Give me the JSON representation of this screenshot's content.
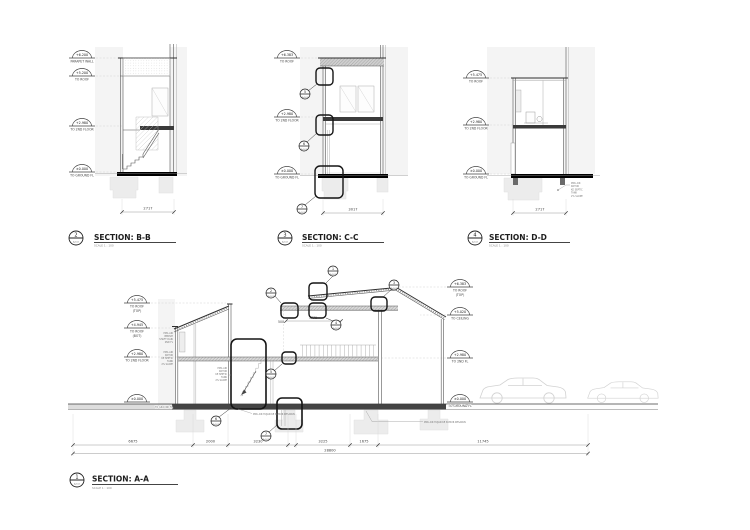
{
  "t": {
    "bb": {
      "num": "2",
      "ref": "A-102",
      "title": "SECTION: B-B",
      "scale": "SCALE  1 : 100"
    },
    "cc": {
      "num": "3",
      "ref": "A-102",
      "title": "SECTION: C-C",
      "scale": "SCALE  1 : 100"
    },
    "dd": {
      "num": "4",
      "ref": "A-102",
      "title": "SECTION: D-D",
      "scale": "SCALE  1 : 100"
    },
    "aa": {
      "num": "1",
      "ref": "A-102",
      "title": "SECTION: A-A",
      "scale": "SCALE  1 : 100"
    }
  },
  "bb": {
    "markers": [
      {
        "v": "+6.200",
        "l1": "PARAPET WALL",
        "l2": ""
      },
      {
        "v": "+5.200",
        "l1": "TO ROOF",
        "l2": ""
      },
      {
        "v": "+2.980",
        "l1": "TO 2ND FLOOR",
        "l2": ""
      },
      {
        "v": "±0.000",
        "l1": "TO GROUND FL",
        "l2": ""
      }
    ],
    "dim": "2717"
  },
  "cc": {
    "markers": [
      {
        "v": "+6.383",
        "l1": "TO ROOF",
        "l2": ""
      },
      {
        "v": "+2.980",
        "l1": "TO 2ND FLOOR",
        "l2": ""
      },
      {
        "v": "±0.000",
        "l1": "TO GROUND FL",
        "l2": ""
      }
    ],
    "dim": "3017",
    "callouts": [
      {
        "n": "5",
        "r": "A-501"
      },
      {
        "n": "6",
        "r": "A-501"
      },
      {
        "n": "7",
        "r": "A-501"
      }
    ]
  },
  "dd": {
    "markers": [
      {
        "v": "+5.475",
        "l1": "TO ROOF",
        "l2": ""
      },
      {
        "v": "+2.980",
        "l1": "TO 2ND FLOOR",
        "l2": ""
      },
      {
        "v": "±0.000",
        "l1": "TO GROUND FL",
        "l2": ""
      }
    ],
    "dim": "2717",
    "note": [
      "PIPA AIR",
      "KOTOR",
      "KE SEPTIC",
      "TANK",
      "2% SLOPE"
    ]
  },
  "aa": {
    "lm": [
      {
        "v": "+5.475",
        "l1": "TO ROOF",
        "l2": "(TOP)"
      },
      {
        "v": "+4.945",
        "l1": "TO ROOF",
        "l2": "(BOT)"
      },
      {
        "v": "+2.980",
        "l1": "TO 2ND FLOOR",
        "l2": ""
      },
      {
        "v": "±0.000",
        "l1": "",
        "l2": ""
      }
    ],
    "rm": [
      {
        "v": "+6.383",
        "l1": "TO ROOF",
        "l2": "(TOP)"
      },
      {
        "v": "+5.020",
        "l1": "TO CEILING",
        "l2": ""
      },
      {
        "v": "+2.980",
        "l1": "TO 2ND FL",
        "l2": ""
      },
      {
        "v": "±0.000",
        "l1": "TO GROUND FL",
        "l2": ""
      }
    ],
    "gl": "TO GROUND FL",
    "dims": [
      "6675",
      "2000",
      "3230",
      "3225",
      "1675",
      "11745"
    ],
    "total": "28800",
    "inner": {
      "d1": "500",
      "d2": "1770"
    },
    "callouts": [
      {
        "n": "1",
        "r": "A-501"
      },
      {
        "n": "2",
        "r": "A-501"
      },
      {
        "n": "3",
        "r": "A-501"
      },
      {
        "n": "4",
        "r": "A-501"
      },
      {
        "n": "5",
        "r": "A-501"
      },
      {
        "n": "6",
        "r": "A-501"
      },
      {
        "n": "7",
        "r": "A-501"
      }
    ],
    "notes": {
      "a": [
        "PIPA AIR",
        "BERSIH",
        "SHAFT DARI",
        "2ND FL"
      ],
      "b": [
        "PIPA AIR",
        "KOTOR",
        "KE SEPTIC",
        "TANK",
        "2% SLOPE"
      ],
      "c": [
        "PIPA AIR",
        "KOTOR",
        "KE SEPTIC",
        "TANK",
        "2% SLOPE"
      ],
      "g1": "PIPA AIR HUJAN KE SUMUR RESAPAN",
      "g2": "PIPA AIR HUJAN KE SUMUR RESAPAN"
    }
  }
}
